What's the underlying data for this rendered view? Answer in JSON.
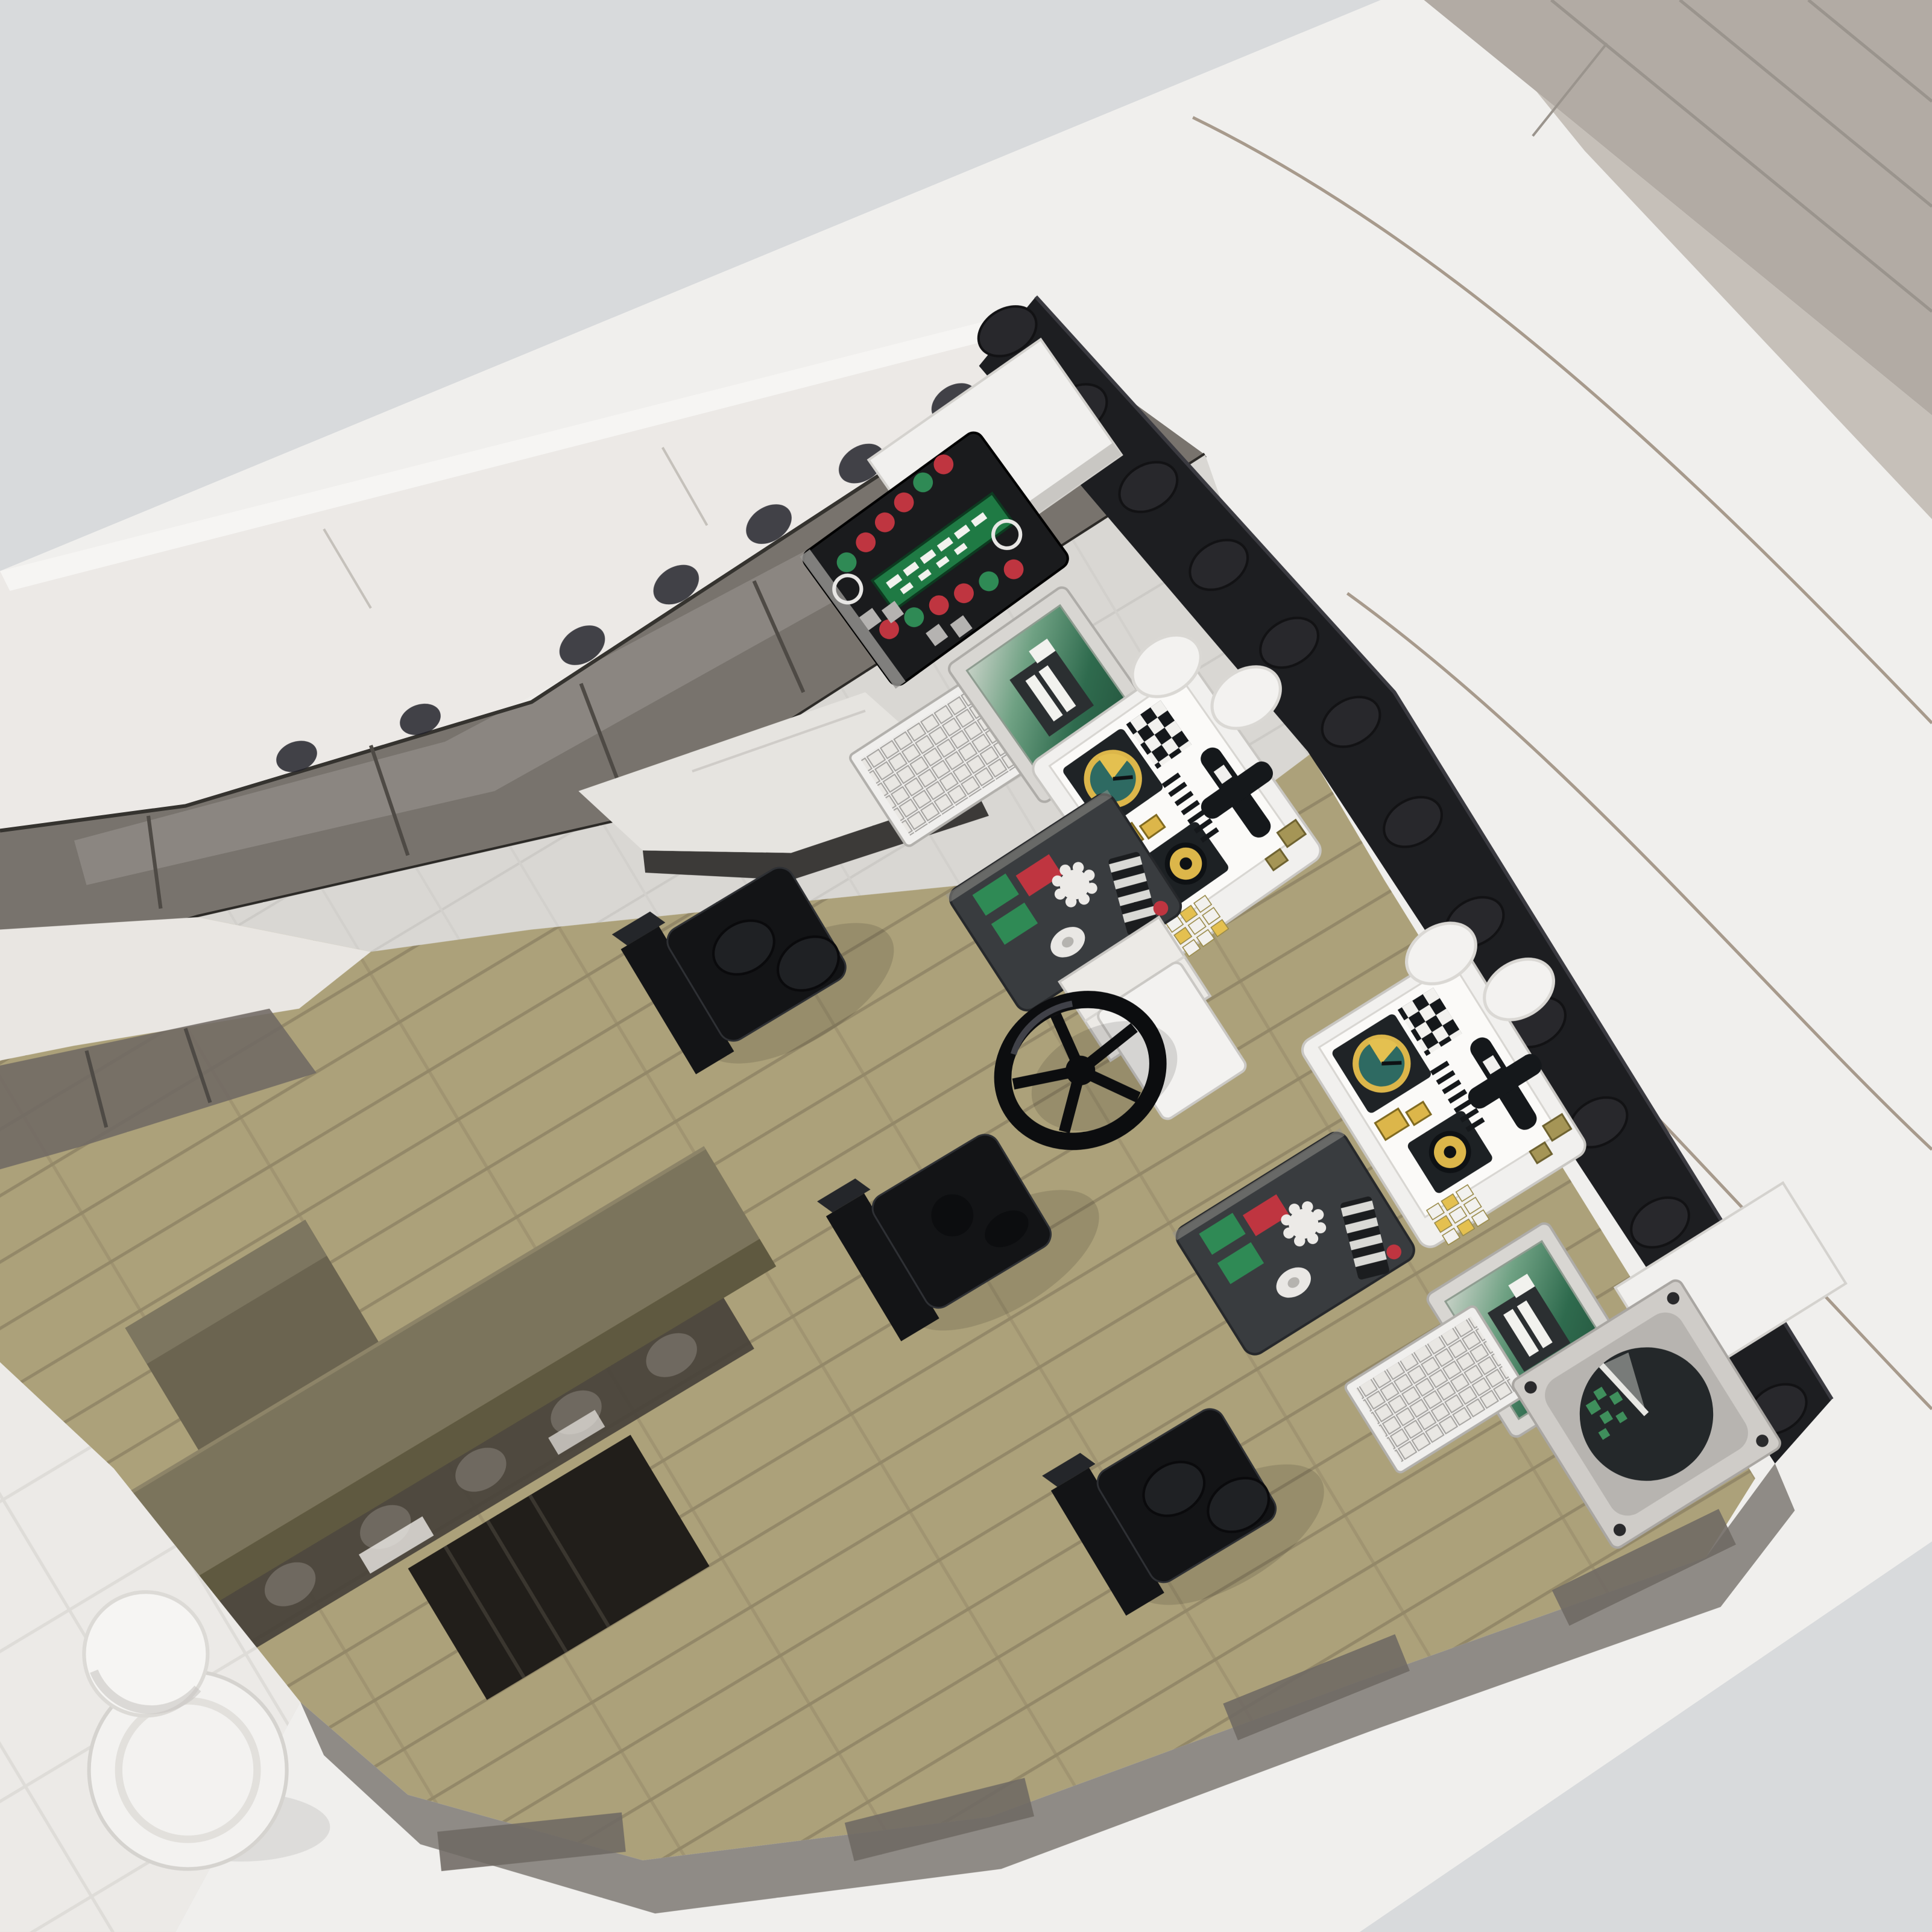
{
  "scene": {
    "type": "3d-render",
    "subject": "Overhead view of a LEGO-style ocean-liner bridge interior: smoke-glass windscreen, black stud walls, instrument consoles with green CRT screens and yellow gauges, ship's wheel, three black chairs on an olive plank floor, lower deck with bench and stairwell, white hull decks around",
    "objects": [
      {
        "name": "backdrop",
        "color": "bg"
      },
      {
        "name": "ship-hull-decks",
        "color": "shipWhite"
      },
      {
        "name": "aft-roof-steps",
        "color": "roofGray"
      },
      {
        "name": "windscreen-glass",
        "color": "glassSmoke"
      },
      {
        "name": "windscreen-frame",
        "color": "frameDark"
      },
      {
        "name": "black-stud-wall",
        "color": "wallBlack"
      },
      {
        "name": "white-tile-on-wall",
        "color": "stickerWhite"
      },
      {
        "name": "bridge-tile-floor",
        "color": "tileGray"
      },
      {
        "name": "chart-desk",
        "color": "deskTop"
      },
      {
        "name": "indicator-light-panel",
        "color": "consoleBlack"
      },
      {
        "name": "keyboard",
        "color": "keyboardWhite"
      },
      {
        "name": "crt-monitor",
        "color": "crtFrame"
      },
      {
        "name": "gauge-console",
        "color": "stickerWhite"
      },
      {
        "name": "helm-switch-panel",
        "color": "panelDark"
      },
      {
        "name": "ships-wheel",
        "color": "chairBlack"
      },
      {
        "name": "wheel-pedestal",
        "color": "bollardWhite"
      },
      {
        "name": "radar-display",
        "color": "radarScreen"
      },
      {
        "name": "captains-chair",
        "color": "chairBlack"
      },
      {
        "name": "plank-floor",
        "color": "floorOlive"
      },
      {
        "name": "lower-deck-bench",
        "color": "benchOlive"
      },
      {
        "name": "stairwell-opening",
        "color": "stairDark"
      },
      {
        "name": "lower-deck-glazing",
        "color": "benchGlass"
      },
      {
        "name": "bow-bollard",
        "color": "bollardWhite"
      },
      {
        "name": "stern-railing",
        "color": "railGray"
      }
    ]
  },
  "palette": {
    "bg": "#d8dadc",
    "shipWhite": "#f0efed",
    "whiteBand": "#ece9e6",
    "whiteBright": "#f6f5f3",
    "roofGray": "#b2aba4",
    "roofGrayLight": "#c6c0b9",
    "deckSeam": "#a79a8c",
    "glassSmoke": "#6f6963",
    "frameDark": "#2c2a27",
    "wallBlack": "#1d1e21",
    "studBlack": "#28282c",
    "tileGray": "#d9d7d3",
    "tileSeam": "#c2c0bc",
    "deskTop": "#e6e4e0",
    "deskUnder": "#3c3a38",
    "floorOlive": "#aca17a",
    "plankSeam": "#8d8264",
    "innerWallWhite": "#e9e6e2",
    "benchOlive": "#7b745c",
    "benchFace": "#5f5940",
    "benchGlass": "#47413a",
    "stairDark": "#211e1a",
    "crateOlive": "#6b6450",
    "chairBlack": "#131416",
    "chairStud": "#1f2124",
    "consoleBlack": "#1a1b1d",
    "panelDark": "#393c3f",
    "silver": "#97958f",
    "displayGreen": "#1f7a44",
    "lightRed": "#bf3540",
    "lightGreen": "#2f8a55",
    "keyboardWhite": "#f0efed",
    "crtFrame": "#d8d6d2",
    "gaugeYellow": "#dcb64a",
    "gaugeTeal": "#2e6a62",
    "stickerWhite": "#f1f0ee",
    "khaki": "#a59556",
    "radarPlate": "#cfccc8",
    "radarInner": "#b7b4b0",
    "radarScreen": "#24282a",
    "radarSweep": "#e8e8e4",
    "radarBlip": "#3f8f5c",
    "railGray": "#8f8b86",
    "bollardWhite": "#f3f2f0",
    "shadow": "#000000"
  }
}
